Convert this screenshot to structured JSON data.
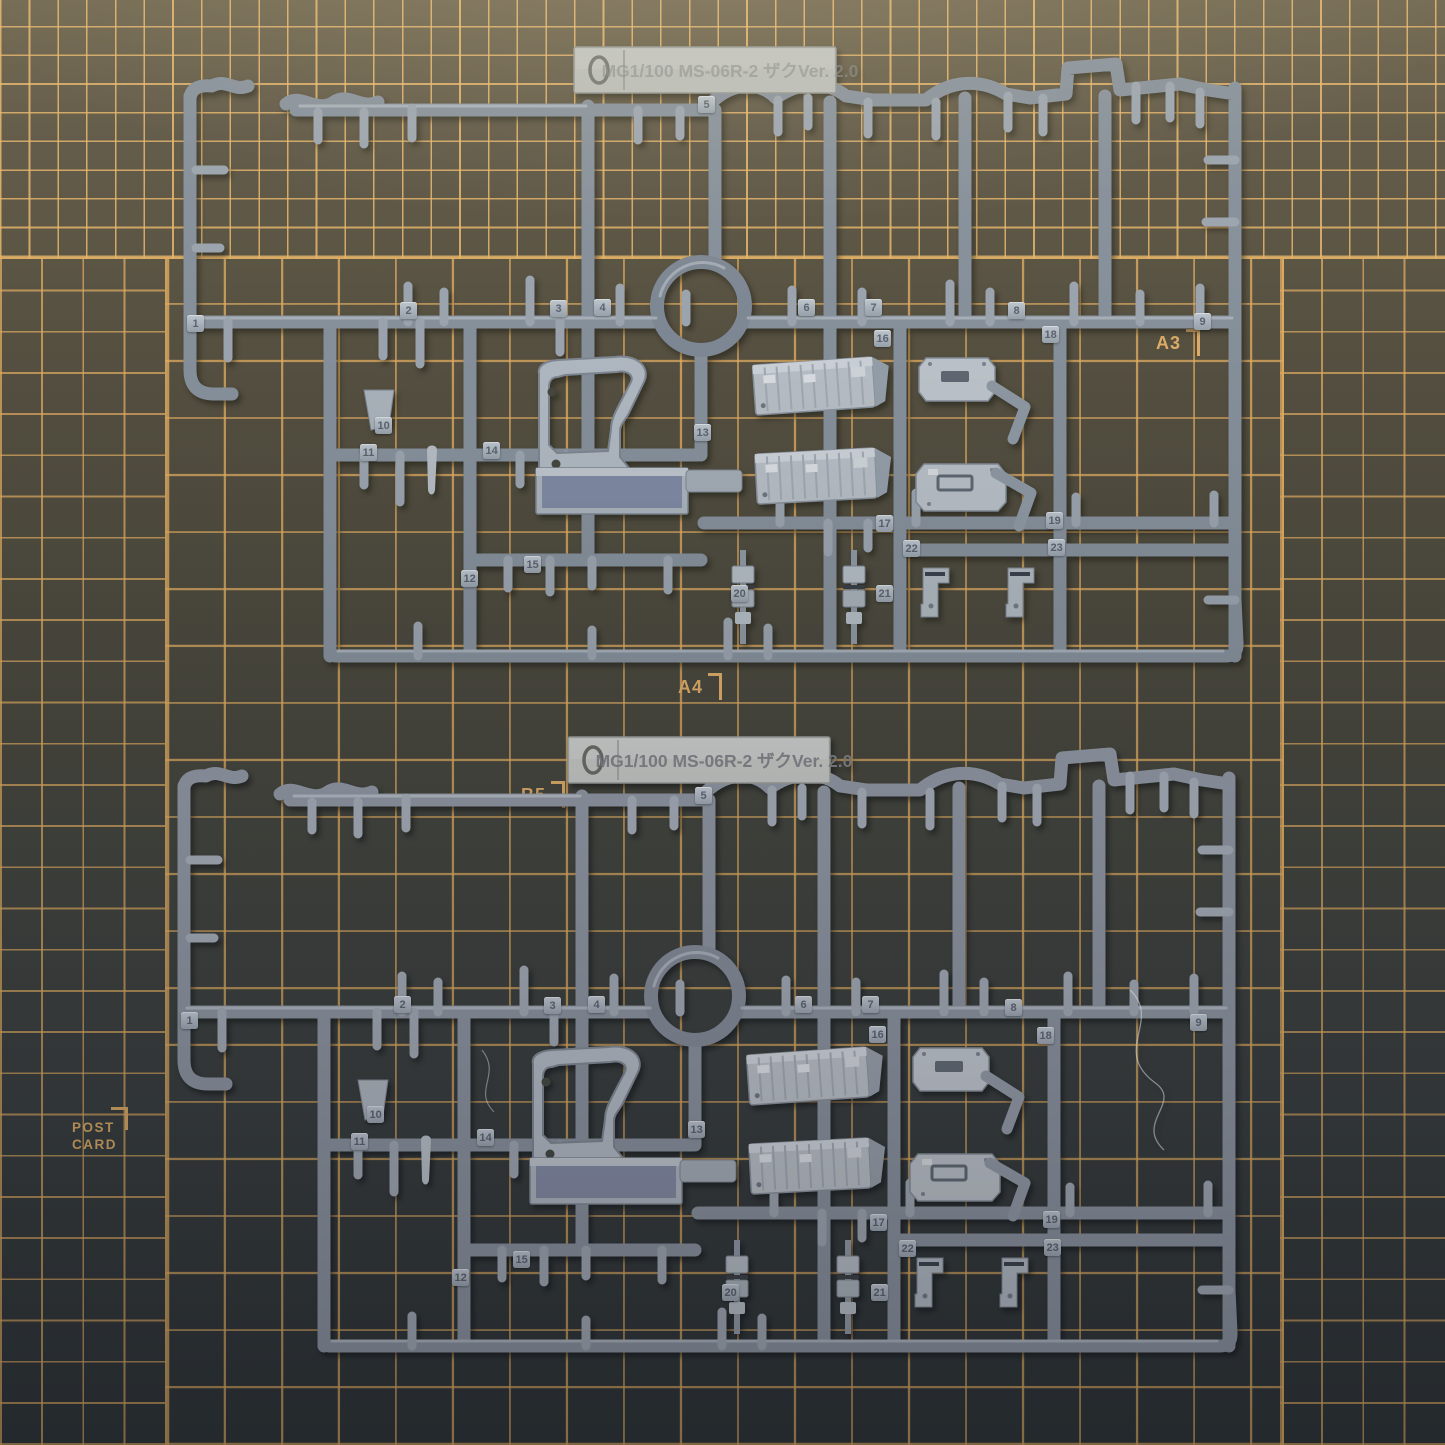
{
  "scene": {
    "description": "Two gray plastic model-kit runners (sprues A and B) of a Bandai MG 1/100 MS-06R-2 Zaku Ver.2.0 kit photographed on a dark cutting mat with tan grid lines"
  },
  "mat": {
    "grid_line_color": "#dcab67",
    "bg_top_color": "#5c5544",
    "bg_bottom_color": "#34383a",
    "size_labels": [
      {
        "id": "a3",
        "label": "A3"
      },
      {
        "id": "a4",
        "label": "A4"
      },
      {
        "id": "b5",
        "label": "B5"
      },
      {
        "id": "postcard",
        "label": "POST CARD",
        "line1": "POST",
        "line2": "CARD"
      }
    ]
  },
  "sprues": {
    "plastic_color": "#8e97a2",
    "plastic_highlight": "#b5bcc3",
    "a": {
      "nameplate": {
        "logo_icon": "bandai-lens-icon",
        "title": "MG1/100 MS-06R-2 ザクVer. 2.0"
      },
      "tags": [
        {
          "label": "1",
          "x": 187,
          "y": 315
        },
        {
          "label": "2",
          "x": 400,
          "y": 302
        },
        {
          "label": "3",
          "x": 550,
          "y": 300
        },
        {
          "label": "4",
          "x": 594,
          "y": 299
        },
        {
          "label": "5",
          "x": 698,
          "y": 96
        },
        {
          "label": "6",
          "x": 798,
          "y": 299
        },
        {
          "label": "7",
          "x": 865,
          "y": 299
        },
        {
          "label": "8",
          "x": 1008,
          "y": 302
        },
        {
          "label": "9",
          "x": 1194,
          "y": 313
        },
        {
          "label": "10",
          "x": 375,
          "y": 417
        },
        {
          "label": "11",
          "x": 360,
          "y": 444
        },
        {
          "label": "12",
          "x": 461,
          "y": 570
        },
        {
          "label": "13",
          "x": 694,
          "y": 424
        },
        {
          "label": "14",
          "x": 483,
          "y": 442
        },
        {
          "label": "15",
          "x": 524,
          "y": 556
        },
        {
          "label": "16",
          "x": 874,
          "y": 330
        },
        {
          "label": "17",
          "x": 876,
          "y": 515
        },
        {
          "label": "18",
          "x": 1042,
          "y": 326
        },
        {
          "label": "19",
          "x": 1046,
          "y": 512
        },
        {
          "label": "20",
          "x": 731,
          "y": 585
        },
        {
          "label": "21",
          "x": 876,
          "y": 585
        },
        {
          "label": "22",
          "x": 903,
          "y": 540
        },
        {
          "label": "23",
          "x": 1048,
          "y": 539
        }
      ]
    },
    "b": {
      "nameplate": {
        "logo_icon": "bandai-lens-icon",
        "title": "MG1/100 MS-06R-2 ザクVer. 2.0"
      },
      "tags": [
        {
          "label": "1",
          "x": 181,
          "y": 1012
        },
        {
          "label": "2",
          "x": 394,
          "y": 996
        },
        {
          "label": "3",
          "x": 544,
          "y": 997
        },
        {
          "label": "4",
          "x": 588,
          "y": 996
        },
        {
          "label": "5",
          "x": 695,
          "y": 787
        },
        {
          "label": "6",
          "x": 795,
          "y": 996
        },
        {
          "label": "7",
          "x": 862,
          "y": 996
        },
        {
          "label": "8",
          "x": 1005,
          "y": 999
        },
        {
          "label": "9",
          "x": 1190,
          "y": 1014
        },
        {
          "label": "10",
          "x": 367,
          "y": 1106
        },
        {
          "label": "11",
          "x": 351,
          "y": 1133
        },
        {
          "label": "12",
          "x": 452,
          "y": 1269
        },
        {
          "label": "13",
          "x": 688,
          "y": 1121
        },
        {
          "label": "14",
          "x": 477,
          "y": 1129
        },
        {
          "label": "15",
          "x": 513,
          "y": 1251
        },
        {
          "label": "16",
          "x": 869,
          "y": 1026
        },
        {
          "label": "17",
          "x": 870,
          "y": 1214
        },
        {
          "label": "18",
          "x": 1037,
          "y": 1027
        },
        {
          "label": "19",
          "x": 1043,
          "y": 1211
        },
        {
          "label": "20",
          "x": 722,
          "y": 1284
        },
        {
          "label": "21",
          "x": 871,
          "y": 1284
        },
        {
          "label": "22",
          "x": 899,
          "y": 1240
        },
        {
          "label": "23",
          "x": 1044,
          "y": 1239
        }
      ]
    }
  }
}
